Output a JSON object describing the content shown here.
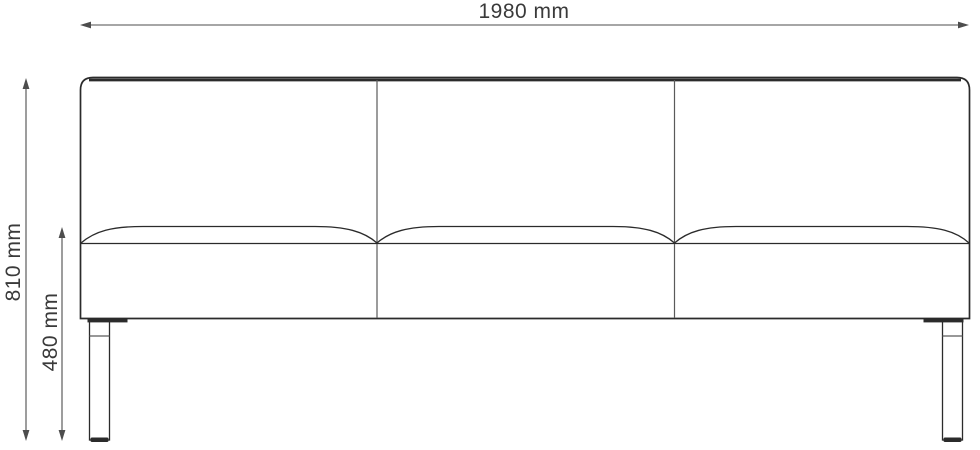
{
  "diagram": {
    "type": "dimension-drawing",
    "subject": "three-seat-sofa-front-elevation"
  },
  "labels": {
    "width": "1980 mm",
    "overall_height": "810 mm",
    "seat_height": "480 mm"
  },
  "dimensions": {
    "width_value": 1980,
    "overall_height_value": 810,
    "seat_height_value": 480,
    "unit": "mm"
  },
  "colors": {
    "background": "#ffffff",
    "line": "#2b2b2b",
    "seam": "#5a5a5a",
    "dimension": "#4d4d4d",
    "text": "#3a3a3a"
  }
}
